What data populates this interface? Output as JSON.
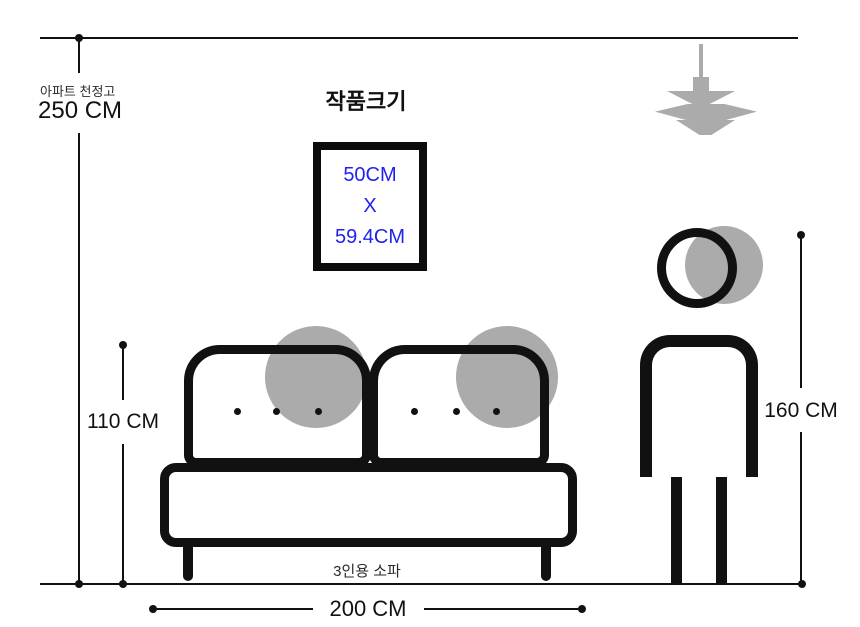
{
  "colors": {
    "ink": "#111111",
    "gray": "#ababab",
    "accent_blue": "#2222ee",
    "background": "#ffffff"
  },
  "ceiling": {
    "caption": "아파트 천정고",
    "value": "250 CM"
  },
  "artwork": {
    "title": "작품크기",
    "size_line1": "50CM",
    "size_line2": "X",
    "size_line3": "59.4CM"
  },
  "sofa": {
    "caption": "3인용 소파",
    "height_value": "110 CM",
    "width_value": "200 CM"
  },
  "person": {
    "height_value": "160 CM"
  },
  "figures": {
    "lamp_icon": "pendant-lamp-icon",
    "sofa_icon": "three-seater-sofa-figure",
    "person_icon": "standing-person-figure",
    "artwork_icon": "picture-frame"
  }
}
